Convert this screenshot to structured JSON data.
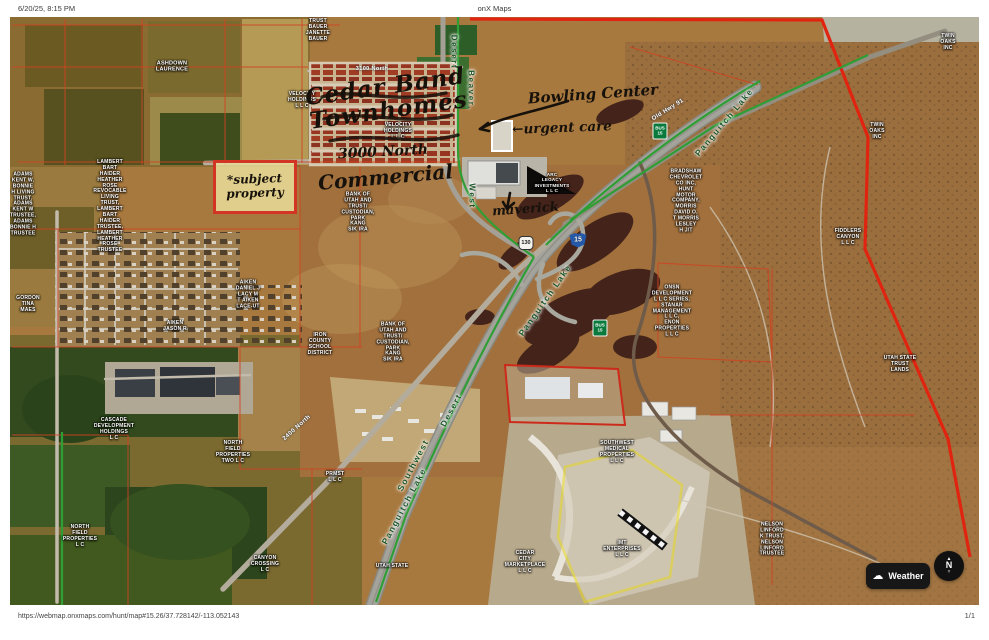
{
  "page": {
    "printed_timestamp": "6/20/25, 8:15 PM",
    "document_title": "onX Maps",
    "footer_url": "https://webmap.onxmaps.com/hunt/map#15.26/37.728142/-113.052143",
    "page_indicator": "1/1"
  },
  "map": {
    "controls": {
      "weather_label": "Weather",
      "compass_north": "N"
    },
    "annotations": {
      "development_scribble": "Cedar Band\nTownhomes",
      "road_3000_north": "3000 North",
      "commercial": "Commercial",
      "subject_property": "*subject\nproperty",
      "bowling_center": "Bowling Center",
      "urgent_care": "←urgent care",
      "maverick": "maverick"
    },
    "colors": {
      "parcel_line": "#cf4422",
      "area_boundary": "#e0240f",
      "unit_boundary": "#2f9e35",
      "subject_highlight": "#d23524",
      "yellow_parcel": "#e8d820"
    },
    "shields": [
      {
        "t": "15",
        "x": 568,
        "y": 223,
        "cls": "shield-i15"
      },
      {
        "t": "BUS\n15",
        "x": 590,
        "y": 311,
        "cls": "shield-bus"
      },
      {
        "t": "BUS\n15",
        "x": 650,
        "y": 114,
        "cls": "shield-bus"
      },
      {
        "t": "130",
        "x": 516,
        "y": 226,
        "cls": "shield-state"
      }
    ],
    "labels": [
      {
        "t": "Desert",
        "x": 444,
        "y": 35,
        "s": 8,
        "r": 90,
        "cls": "unit"
      },
      {
        "t": "Beaver,",
        "x": 461,
        "y": 73,
        "s": 8,
        "r": 90,
        "cls": "unit"
      },
      {
        "t": "West",
        "x": 462,
        "y": 179,
        "s": 8,
        "r": 90,
        "cls": "unit"
      },
      {
        "t": "Panguitch Lake",
        "x": 714,
        "y": 105,
        "s": 8.5,
        "r": -50,
        "cls": "unit"
      },
      {
        "t": "Panguitch Lake",
        "x": 535,
        "y": 283,
        "s": 8.5,
        "r": -55,
        "cls": "unit"
      },
      {
        "t": "Panguitch Lake",
        "x": 394,
        "y": 489,
        "s": 8.5,
        "r": -62,
        "cls": "unit"
      },
      {
        "t": "Southwest",
        "x": 403,
        "y": 448,
        "s": 8.5,
        "r": -62,
        "cls": "unit"
      },
      {
        "t": "Desert",
        "x": 441,
        "y": 393,
        "s": 8.5,
        "r": -62,
        "cls": "unit"
      },
      {
        "t": "Old Hwy 91",
        "x": 658,
        "y": 93,
        "s": 6,
        "r": -32,
        "cls": "road"
      },
      {
        "t": "3100 North",
        "x": 362,
        "y": 52,
        "s": 5.5,
        "r": 0,
        "cls": "road"
      },
      {
        "t": "2400 North",
        "x": 287,
        "y": 411,
        "s": 6,
        "r": -42,
        "cls": "road"
      },
      {
        "t": "TRUST\nBAUER\nJANETTE\nBAUER",
        "x": 308,
        "y": 14,
        "s": 5,
        "r": 0,
        "cls": "parcel"
      },
      {
        "t": "ASHDOWN\nLAURENCE",
        "x": 162,
        "y": 50,
        "s": 5.5,
        "r": 0,
        "cls": "parcel"
      },
      {
        "t": "VELOCITY\nHOLDINGS\nL L C",
        "x": 292,
        "y": 84,
        "s": 5,
        "r": 0,
        "cls": "parcel"
      },
      {
        "t": "VELOCITY\nHOLDINGS\nL L C",
        "x": 388,
        "y": 115,
        "s": 5,
        "r": 0,
        "cls": "parcel"
      },
      {
        "t": "ADAMS\nKENT W,\nBONNIE\nH LIVING\nTRUST,\nADAMS\nKENT W\nTRUSTEE,\nADAMS\nBONNIE H\nTRUSTEE",
        "x": 13,
        "y": 188,
        "s": 5,
        "r": 0,
        "cls": "parcel"
      },
      {
        "t": "LAMBERT\nBART\nHAIDER\nHEATHER\nROSE\nREVOCABLE\nLIVING\nTRUST,\nLAMBERT\nBART\nHAIDER\nTRUSTEE,\nLAMBERT\nHEATHER\nROSE\nTRUSTEE",
        "x": 100,
        "y": 190,
        "s": 5,
        "r": 0,
        "cls": "parcel"
      },
      {
        "t": "GORDON\nTINA\nMAES",
        "x": 18,
        "y": 288,
        "s": 5,
        "r": 0,
        "cls": "parcel"
      },
      {
        "t": "AIKEN\nJASON R",
        "x": 165,
        "y": 310,
        "s": 5,
        "r": 0,
        "cls": "parcel"
      },
      {
        "t": "AIKEN\nDANIEL J\nLACY M\nT AIKEN\nLACE-UT",
        "x": 238,
        "y": 278,
        "s": 5,
        "r": 0,
        "cls": "parcel"
      },
      {
        "t": "IRON\nCOUNTY\nSCHOOL\nDISTRICT",
        "x": 310,
        "y": 328,
        "s": 5,
        "r": 0,
        "cls": "parcel"
      },
      {
        "t": "BANK OF\nUTAH AND\nTRUST/\nCUSTODIAN,\nPARK\nKANG\nSIK IRA",
        "x": 348,
        "y": 196,
        "s": 5,
        "r": 0,
        "cls": "parcel"
      },
      {
        "t": "BANK OF\nUTAH AND\nTRUST/\nCUSTODIAN,\nPARK\nKANG\nSIK IRA",
        "x": 383,
        "y": 326,
        "s": 5,
        "r": 0,
        "cls": "parcel"
      },
      {
        "t": "ARC\nLEGACY\nINVESTMENTS\nL L C",
        "x": 542,
        "y": 166,
        "s": 4.6,
        "r": 0,
        "cls": "parcel"
      },
      {
        "t": "BRADSHAW\nCHEVROLET\nCO INC,\nHUNT\nMOTOR\nCOMPANY,\nMORRIS\nDAVID O,\nT MORRIS\nLESLEY\nH J/T",
        "x": 676,
        "y": 185,
        "s": 5,
        "r": 0,
        "cls": "parcel"
      },
      {
        "t": "ONSN\nDEVELOPMENT\nL L C SERIES,\nSTANAR\nMANAGEMENT\nL L C,\nENON\nPROPERTIES\nL L C",
        "x": 662,
        "y": 295,
        "s": 5,
        "r": 0,
        "cls": "parcel"
      },
      {
        "t": "FIDDLERS\nCANYON\nL L C",
        "x": 838,
        "y": 221,
        "s": 5,
        "r": 0,
        "cls": "parcel"
      },
      {
        "t": "UTAH STATE\nTRUST\nLANDS",
        "x": 890,
        "y": 348,
        "s": 5,
        "r": 0,
        "cls": "parcel"
      },
      {
        "t": "TWIN\nOAKS\nINC",
        "x": 938,
        "y": 26,
        "s": 5,
        "r": 0,
        "cls": "parcel"
      },
      {
        "t": "TWIN\nOAKS\nINC",
        "x": 867,
        "y": 115,
        "s": 5,
        "r": 0,
        "cls": "parcel"
      },
      {
        "t": "NELSON\nLINFORD\nK TRUST,\nNELSON\nLINFORD\nTRUSTEE",
        "x": 762,
        "y": 523,
        "s": 5,
        "r": 0,
        "cls": "parcel"
      },
      {
        "t": "IMT\nENTERPRISES\nL L C",
        "x": 612,
        "y": 533,
        "s": 5,
        "r": 0,
        "cls": "parcel"
      },
      {
        "t": "SOUTHWEST\nMEDICAL\nPROPERTIES\nL L C",
        "x": 607,
        "y": 436,
        "s": 5,
        "r": 0,
        "cls": "parcel"
      },
      {
        "t": "CEDAR\nCITY\nMARKETPLACE\nL L C",
        "x": 515,
        "y": 546,
        "s": 5,
        "r": 0,
        "cls": "parcel"
      },
      {
        "t": "UTAH STATE",
        "x": 382,
        "y": 550,
        "s": 5,
        "r": 0,
        "cls": "parcel"
      },
      {
        "t": "CANYON\nCROSSING\nL C",
        "x": 255,
        "y": 548,
        "s": 5,
        "r": 0,
        "cls": "parcel"
      },
      {
        "t": "NORTH\nFIELD\nPROPERTIES\nTWO L C",
        "x": 223,
        "y": 436,
        "s": 5,
        "r": 0,
        "cls": "parcel"
      },
      {
        "t": "NORTH\nFIELD\nPROPERTIES\nL C",
        "x": 70,
        "y": 520,
        "s": 5,
        "r": 0,
        "cls": "parcel"
      },
      {
        "t": "CASCADE\nDEVELOPMENT\nHOLDINGS\nL C",
        "x": 104,
        "y": 413,
        "s": 5,
        "r": 0,
        "cls": "parcel"
      },
      {
        "t": "PRMST\nL L C",
        "x": 325,
        "y": 461,
        "s": 5,
        "r": 0,
        "cls": "parcel"
      }
    ]
  }
}
